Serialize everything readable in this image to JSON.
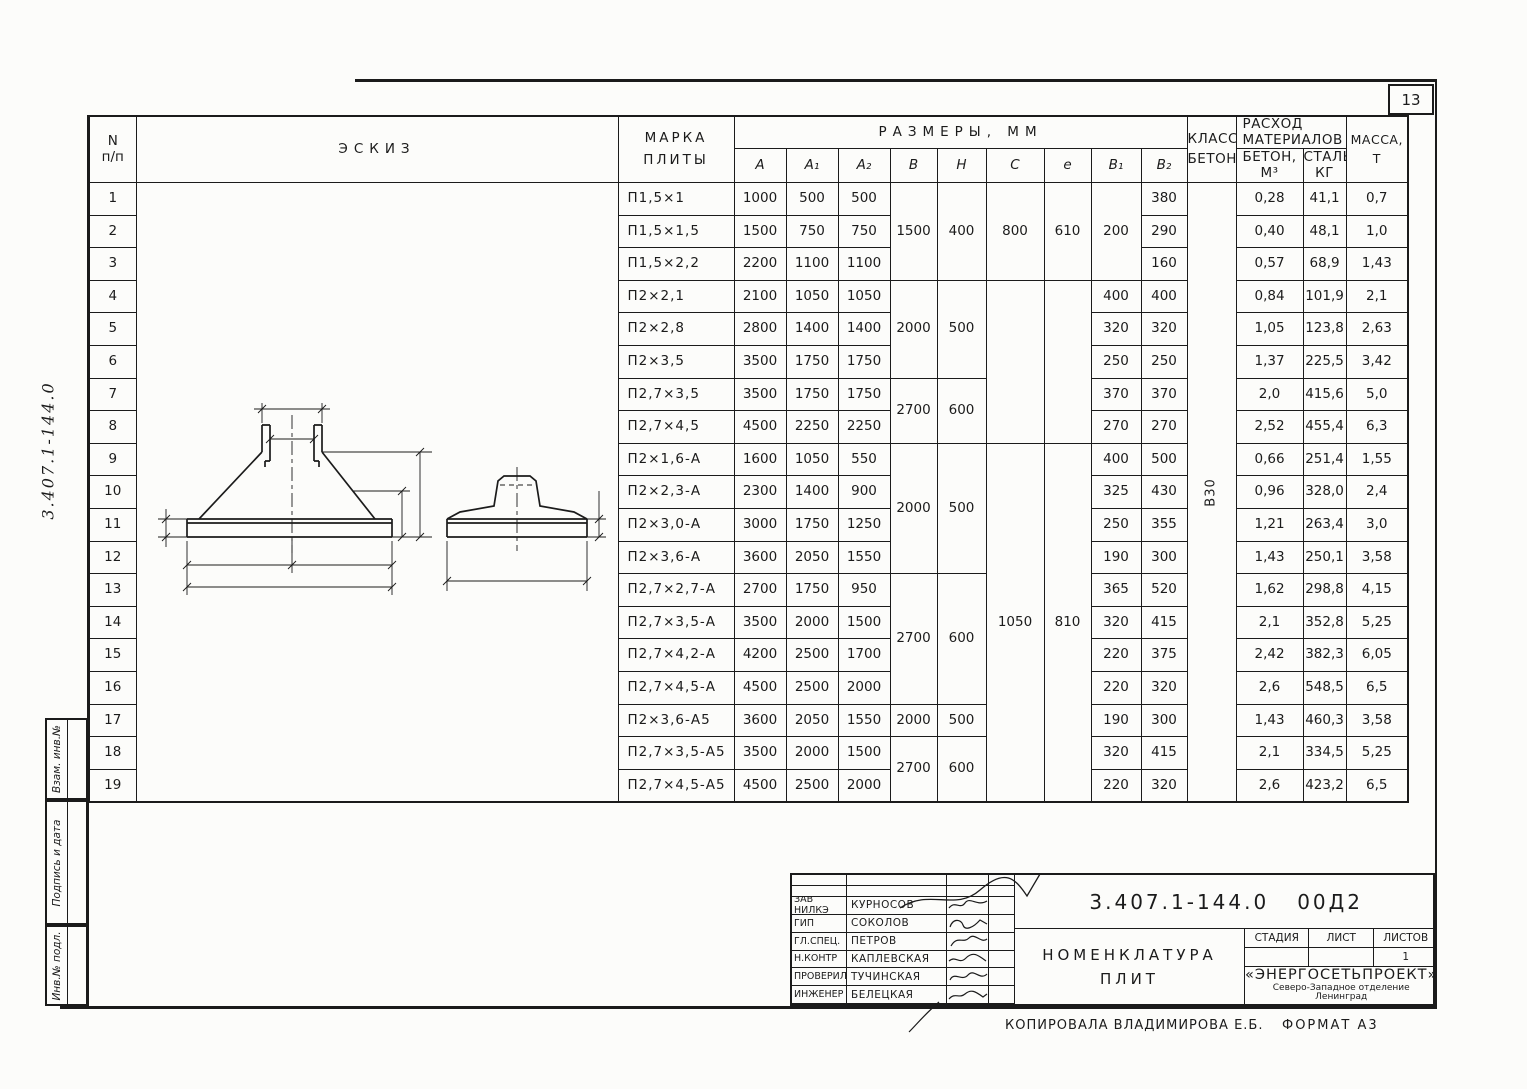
{
  "page": {
    "number": "13"
  },
  "side": {
    "code": "3.407.1-144.0",
    "stamps": [
      "Взам. инв.№",
      "Подпись и дата",
      "Инв.№ подл."
    ]
  },
  "table": {
    "headers": {
      "num1": "N",
      "num2": "п/п",
      "sketch": "Эскиз",
      "mark1": "Марка",
      "mark2": "плиты",
      "sizes": "Размеры, мм",
      "size_cols": [
        "A",
        "A₁",
        "A₂",
        "В",
        "Н",
        "С",
        "е",
        "В₁",
        "В₂"
      ],
      "cls1": "Класс",
      "cls2": "бетона",
      "cons1": "Расход",
      "cons2": "материалов",
      "concrete1": "Бетон,",
      "concrete2": "м³",
      "steel1": "Сталь,",
      "steel2": "кг",
      "mass1": "Масса,",
      "mass2": "т"
    },
    "rows": [
      {
        "n": "1",
        "mark": "П1,5×1",
        "A": "1000",
        "A1": "500",
        "A2": "500",
        "B": [
          "1500",
          3
        ],
        "H": [
          "400",
          3
        ],
        "C": [
          "800",
          3
        ],
        "e": [
          "610",
          3
        ],
        "B1": [
          "200",
          3
        ],
        "B2": "380",
        "cls": [
          "В30",
          19
        ],
        "conc": "0,28",
        "steel": "41,1",
        "mass": "0,7"
      },
      {
        "n": "2",
        "mark": "П1,5×1,5",
        "A": "1500",
        "A1": "750",
        "A2": "750",
        "B2": "290",
        "conc": "0,40",
        "steel": "48,1",
        "mass": "1,0"
      },
      {
        "n": "3",
        "mark": "П1,5×2,2",
        "A": "2200",
        "A1": "1100",
        "A2": "1100",
        "B2": "160",
        "conc": "0,57",
        "steel": "68,9",
        "mass": "1,43"
      },
      {
        "n": "4",
        "mark": "П2×2,1",
        "A": "2100",
        "A1": "1050",
        "A2": "1050",
        "B": [
          "2000",
          3
        ],
        "H": [
          "500",
          3
        ],
        "C": [
          "",
          5
        ],
        "e": [
          "",
          5
        ],
        "B1": "400",
        "B2": "400",
        "conc": "0,84",
        "steel": "101,9",
        "mass": "2,1"
      },
      {
        "n": "5",
        "mark": "П2×2,8",
        "A": "2800",
        "A1": "1400",
        "A2": "1400",
        "B1": "320",
        "B2": "320",
        "conc": "1,05",
        "steel": "123,8",
        "mass": "2,63"
      },
      {
        "n": "6",
        "mark": "П2×3,5",
        "A": "3500",
        "A1": "1750",
        "A2": "1750",
        "B1": "250",
        "B2": "250",
        "conc": "1,37",
        "steel": "225,5",
        "mass": "3,42"
      },
      {
        "n": "7",
        "mark": "П2,7×3,5",
        "A": "3500",
        "A1": "1750",
        "A2": "1750",
        "B": [
          "2700",
          2
        ],
        "H": [
          "600",
          2
        ],
        "B1": "370",
        "B2": "370",
        "conc": "2,0",
        "steel": "415,6",
        "mass": "5,0"
      },
      {
        "n": "8",
        "mark": "П2,7×4,5",
        "A": "4500",
        "A1": "2250",
        "A2": "2250",
        "B1": "270",
        "B2": "270",
        "conc": "2,52",
        "steel": "455,4",
        "mass": "6,3"
      },
      {
        "n": "9",
        "mark": "П2×1,6-А",
        "A": "1600",
        "A1": "1050",
        "A2": "550",
        "B": [
          "2000",
          4
        ],
        "H": [
          "500",
          4
        ],
        "C": [
          "1050",
          11
        ],
        "e": [
          "810",
          11
        ],
        "B1": "400",
        "B2": "500",
        "conc": "0,66",
        "steel": "251,4",
        "mass": "1,55"
      },
      {
        "n": "10",
        "mark": "П2×2,3-А",
        "A": "2300",
        "A1": "1400",
        "A2": "900",
        "B1": "325",
        "B2": "430",
        "conc": "0,96",
        "steel": "328,0",
        "mass": "2,4"
      },
      {
        "n": "11",
        "mark": "П2×3,0-А",
        "A": "3000",
        "A1": "1750",
        "A2": "1250",
        "B1": "250",
        "B2": "355",
        "conc": "1,21",
        "steel": "263,4",
        "mass": "3,0"
      },
      {
        "n": "12",
        "mark": "П2×3,6-А",
        "A": "3600",
        "A1": "2050",
        "A2": "1550",
        "B1": "190",
        "B2": "300",
        "conc": "1,43",
        "steel": "250,1",
        "mass": "3,58"
      },
      {
        "n": "13",
        "mark": "П2,7×2,7-А",
        "A": "2700",
        "A1": "1750",
        "A2": "950",
        "B": [
          "2700",
          4
        ],
        "H": [
          "600",
          4
        ],
        "B1": "365",
        "B2": "520",
        "conc": "1,62",
        "steel": "298,8",
        "mass": "4,15"
      },
      {
        "n": "14",
        "mark": "П2,7×3,5-А",
        "A": "3500",
        "A1": "2000",
        "A2": "1500",
        "B1": "320",
        "B2": "415",
        "conc": "2,1",
        "steel": "352,8",
        "mass": "5,25"
      },
      {
        "n": "15",
        "mark": "П2,7×4,2-А",
        "A": "4200",
        "A1": "2500",
        "A2": "1700",
        "B1": "220",
        "B2": "375",
        "conc": "2,42",
        "steel": "382,3",
        "mass": "6,05"
      },
      {
        "n": "16",
        "mark": "П2,7×4,5-А",
        "A": "4500",
        "A1": "2500",
        "A2": "2000",
        "B1": "220",
        "B2": "320",
        "conc": "2,6",
        "steel": "548,5",
        "mass": "6,5"
      },
      {
        "n": "17",
        "mark": "П2×3,6-А5",
        "A": "3600",
        "A1": "2050",
        "A2": "1550",
        "B": "2000",
        "H": "500",
        "B1": "190",
        "B2": "300",
        "conc": "1,43",
        "steel": "460,3",
        "mass": "3,58"
      },
      {
        "n": "18",
        "mark": "П2,7×3,5-А5",
        "A": "3500",
        "A1": "2000",
        "A2": "1500",
        "B": [
          "2700",
          2
        ],
        "H": [
          "600",
          2
        ],
        "B1": "320",
        "B2": "415",
        "conc": "2,1",
        "steel": "334,5",
        "mass": "5,25"
      },
      {
        "n": "19",
        "mark": "П2,7×4,5-А5",
        "A": "4500",
        "A1": "2500",
        "A2": "2000",
        "B1": "220",
        "B2": "320",
        "conc": "2,6",
        "steel": "423,2",
        "mass": "6,5"
      }
    ]
  },
  "sketch": {
    "labels": {
      "c": "C",
      "e": "е",
      "b1": "В₁",
      "b2": "В₂",
      "h": "Н",
      "a1": "A₁",
      "a2": "A₂",
      "a": "A",
      "b": "В",
      "dim100": "100"
    }
  },
  "titleblock": {
    "signatures": [
      {
        "role": "Зав НИЛКЭ",
        "name": "Курносов"
      },
      {
        "role": "ГИП",
        "name": "Соколов"
      },
      {
        "role": "Гл.спец.",
        "name": "Петров"
      },
      {
        "role": "Н.контр",
        "name": "Каплевская"
      },
      {
        "role": "Проверил",
        "name": "Тучинская"
      },
      {
        "role": "Инженер",
        "name": "Белецкая"
      }
    ],
    "code": "3.407.1-144.0",
    "code2": "00Д2",
    "title1": "Номенклатура",
    "title2": "плит",
    "stage_h": "Стадия",
    "sheet_h": "Лист",
    "sheets_h": "Листов",
    "stage_v": "",
    "sheet_v": "",
    "sheets_v": "1",
    "org1": "«ЭНЕРГОСЕТЬПРОЕКТ»",
    "org2": "Северо-Западное отделение",
    "org3": "Ленинград"
  },
  "footer": {
    "copied": "Копировала Владимирова Е.Б.",
    "format": "Формат А3"
  }
}
